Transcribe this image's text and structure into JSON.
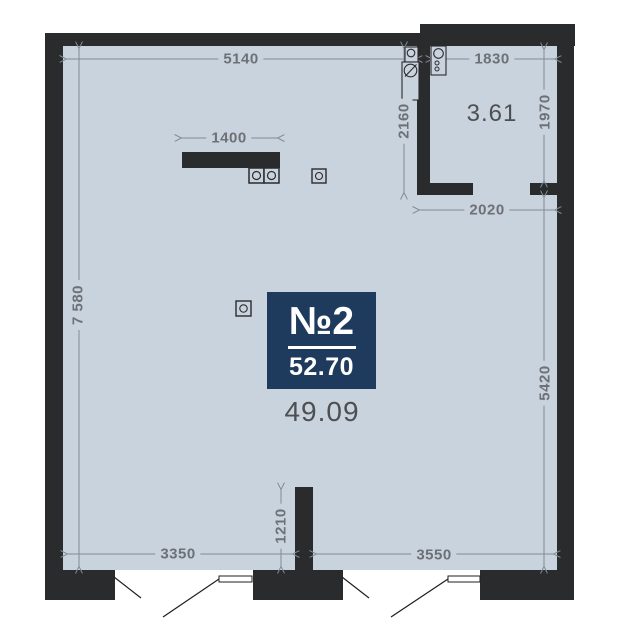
{
  "plan": {
    "unit": {
      "number": "№2",
      "total_area": "52.70"
    },
    "rooms": {
      "main_area": "49.09",
      "bathroom_area": "3.61"
    },
    "dimensions": {
      "top_main": "5140",
      "bath_width": "1830",
      "bath_height": "1970",
      "partition_height": "2160",
      "below_bath_width": "2020",
      "left_height": "7 580",
      "right_lower_height": "5420",
      "counter_width": "1400",
      "bottom_left_width": "3350",
      "stub_height": "1210",
      "bottom_right_width": "3550"
    },
    "colors": {
      "wall": "#2a2b2d",
      "floor": "#c9d3dd",
      "badge": "#1e3a5c",
      "dim": "#6d7176",
      "line": "#7e8b97",
      "room": "#4d4f52"
    },
    "icons": {
      "stove_burner": "circle-in-square",
      "outlet": "circle-in-square",
      "sink": "circle-in-box",
      "washing_machine": "slashed-circle-in-box",
      "bath_sink": "circle-with-dots",
      "door_swing": "diagonal-leaf-lines"
    }
  }
}
